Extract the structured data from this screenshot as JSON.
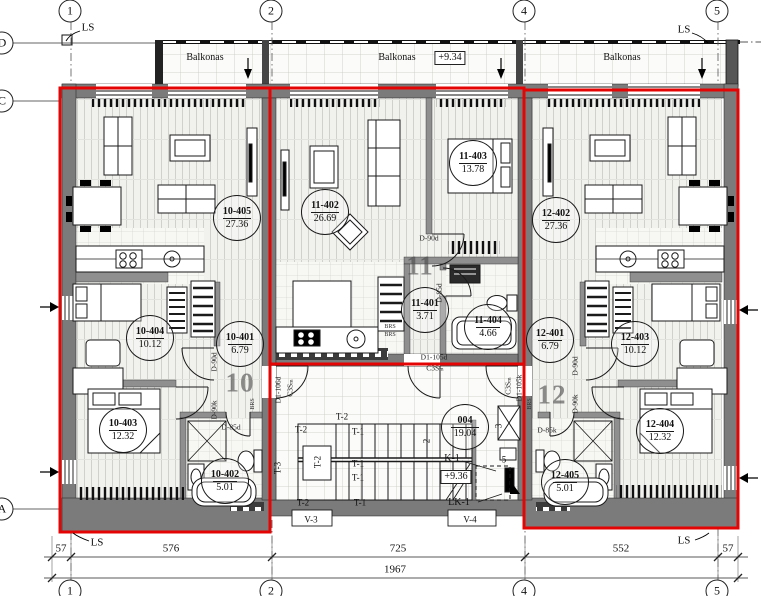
{
  "colors": {
    "unit_outline": "#e40404",
    "wall": "#7b7b7b",
    "partition": "#8f8f8f"
  },
  "grid": {
    "top": [
      {
        "label": "1",
        "x": 70
      },
      {
        "label": "2",
        "x": 271
      },
      {
        "label": "4",
        "x": 524
      },
      {
        "label": "5",
        "x": 717
      }
    ],
    "bottom": [
      {
        "label": "1",
        "x": 70
      },
      {
        "label": "2",
        "x": 271
      },
      {
        "label": "4",
        "x": 524
      },
      {
        "label": "5",
        "x": 717
      }
    ],
    "left": [
      {
        "label": "D",
        "y": 43
      },
      {
        "label": "C",
        "y": 101
      },
      {
        "label": "A",
        "y": 509
      }
    ]
  },
  "balcony": {
    "labels": [
      {
        "text": "Balkonas",
        "x": 205,
        "y": 58
      },
      {
        "text": "Balkonas",
        "x": 397,
        "y": 58
      },
      {
        "text": "Balkonas",
        "x": 622,
        "y": 58
      }
    ],
    "level": {
      "text": "+9.34",
      "x": 450,
      "y": 58
    }
  },
  "apartments": [
    {
      "number": "10",
      "x": 240,
      "y": 383,
      "rooms": [
        {
          "code": "10-405",
          "area": "27.36",
          "x": 237,
          "y": 218
        },
        {
          "code": "10-404",
          "area": "10.12",
          "x": 150,
          "y": 338
        },
        {
          "code": "10-401",
          "area": "6.79",
          "x": 240,
          "y": 344
        },
        {
          "code": "10-403",
          "area": "12.32",
          "x": 123,
          "y": 430
        },
        {
          "code": "10-402",
          "area": "5.01",
          "x": 225,
          "y": 481
        }
      ]
    },
    {
      "number": "11",
      "x": 420,
      "y": 266,
      "rooms": [
        {
          "code": "11-402",
          "area": "26.69",
          "x": 325,
          "y": 212
        },
        {
          "code": "11-403",
          "area": "13.78",
          "x": 473,
          "y": 163
        },
        {
          "code": "11-401",
          "area": "3.71",
          "x": 425,
          "y": 310
        },
        {
          "code": "11-404",
          "area": "4.66",
          "x": 488,
          "y": 327
        }
      ]
    },
    {
      "number": "12",
      "x": 552,
      "y": 395,
      "rooms": [
        {
          "code": "12-402",
          "area": "27.36",
          "x": 556,
          "y": 220
        },
        {
          "code": "12-401",
          "area": "6.79",
          "x": 550,
          "y": 340
        },
        {
          "code": "12-403",
          "area": "10.12",
          "x": 635,
          "y": 344
        },
        {
          "code": "12-404",
          "area": "12.32",
          "x": 660,
          "y": 431
        },
        {
          "code": "12-405",
          "area": "5.01",
          "x": 565,
          "y": 482
        }
      ]
    }
  ],
  "stairwell": {
    "tag": {
      "code": "004",
      "area": "19.04",
      "x": 465,
      "y": 427
    },
    "level": {
      "text": "+9.36",
      "x": 456,
      "y": 477
    },
    "labels": [
      {
        "t": "T-2",
        "x": 342,
        "y": 417,
        "c": "stair"
      },
      {
        "t": "T-2",
        "x": 301,
        "y": 430,
        "c": "stair"
      },
      {
        "t": "T-1",
        "x": 358,
        "y": 432,
        "c": "stair"
      },
      {
        "t": "T-1",
        "x": 358,
        "y": 464,
        "c": "stair"
      },
      {
        "t": "T-1",
        "x": 358,
        "y": 478,
        "c": "stair"
      },
      {
        "t": "T-2",
        "x": 318,
        "y": 462,
        "c": "stair",
        "rot": true
      },
      {
        "t": "T-3",
        "x": 278,
        "y": 468,
        "c": "stair",
        "rot": true
      },
      {
        "t": "T-2",
        "x": 303,
        "y": 503,
        "c": "stair"
      },
      {
        "t": "T-1",
        "x": 360,
        "y": 503,
        "c": "stair"
      },
      {
        "t": "K-1",
        "x": 452,
        "y": 459,
        "c": "k"
      },
      {
        "t": "LK-1",
        "x": 459,
        "y": 503,
        "c": "k"
      },
      {
        "t": "V-3",
        "x": 311,
        "y": 520,
        "c": "vent"
      },
      {
        "t": "V-4",
        "x": 470,
        "y": 520,
        "c": "vent"
      },
      {
        "t": "2",
        "x": 427,
        "y": 441,
        "c": "num",
        "rot": true
      },
      {
        "t": "3",
        "x": 499,
        "y": 426,
        "c": "num",
        "rot": true
      },
      {
        "t": "5",
        "x": 504,
        "y": 460,
        "c": "num"
      }
    ]
  },
  "door_labels": [
    {
      "t": "D-90d",
      "x": 214,
      "y": 362,
      "rot": true
    },
    {
      "t": "D-90k",
      "x": 214,
      "y": 410,
      "rot": true
    },
    {
      "t": "D-85d",
      "x": 231,
      "y": 427
    },
    {
      "t": "D-90d",
      "x": 429,
      "y": 238
    },
    {
      "t": "D-85d",
      "x": 439,
      "y": 293,
      "rot": true
    },
    {
      "t": "D-85k",
      "x": 547,
      "y": 430
    },
    {
      "t": "D-90d",
      "x": 575,
      "y": 366,
      "rot": true
    },
    {
      "t": "D-90k",
      "x": 575,
      "y": 404,
      "rot": true
    },
    {
      "t": "D1-106d",
      "x": 278,
      "y": 390,
      "rot": true
    },
    {
      "t": "C3Sₘ",
      "x": 290,
      "y": 388,
      "rot": true
    },
    {
      "t": "D1-105d",
      "x": 434,
      "y": 357
    },
    {
      "t": "C3Sₘ",
      "x": 435,
      "y": 368
    },
    {
      "t": "C3Sₘ",
      "x": 508,
      "y": 386,
      "rot": true
    },
    {
      "t": "D1-105k",
      "x": 519,
      "y": 388,
      "rot": true
    },
    {
      "t": "BRS",
      "x": 390,
      "y": 327,
      "c": "brs"
    },
    {
      "t": "BRS",
      "x": 390,
      "y": 335,
      "c": "brs"
    },
    {
      "t": "BRS",
      "x": 253,
      "y": 404,
      "c": "brs",
      "rot": true
    },
    {
      "t": "BRS",
      "x": 530,
      "y": 404,
      "c": "brs",
      "rot": true
    }
  ],
  "ls_labels": [
    {
      "t": "LS",
      "x": 88,
      "y": 28
    },
    {
      "t": "LS",
      "x": 684,
      "y": 30
    },
    {
      "t": "LS",
      "x": 97,
      "y": 543
    },
    {
      "t": "LS",
      "x": 684,
      "y": 541
    }
  ],
  "dimensions": {
    "row1": [
      {
        "text": "57",
        "x": 61,
        "y": 549
      },
      {
        "text": "576",
        "x": 171,
        "y": 549
      },
      {
        "text": "725",
        "x": 398,
        "y": 549
      },
      {
        "text": "552",
        "x": 621,
        "y": 549
      },
      {
        "text": "57",
        "x": 728,
        "y": 549
      }
    ],
    "total": {
      "text": "1967",
      "x": 395,
      "y": 570
    }
  }
}
